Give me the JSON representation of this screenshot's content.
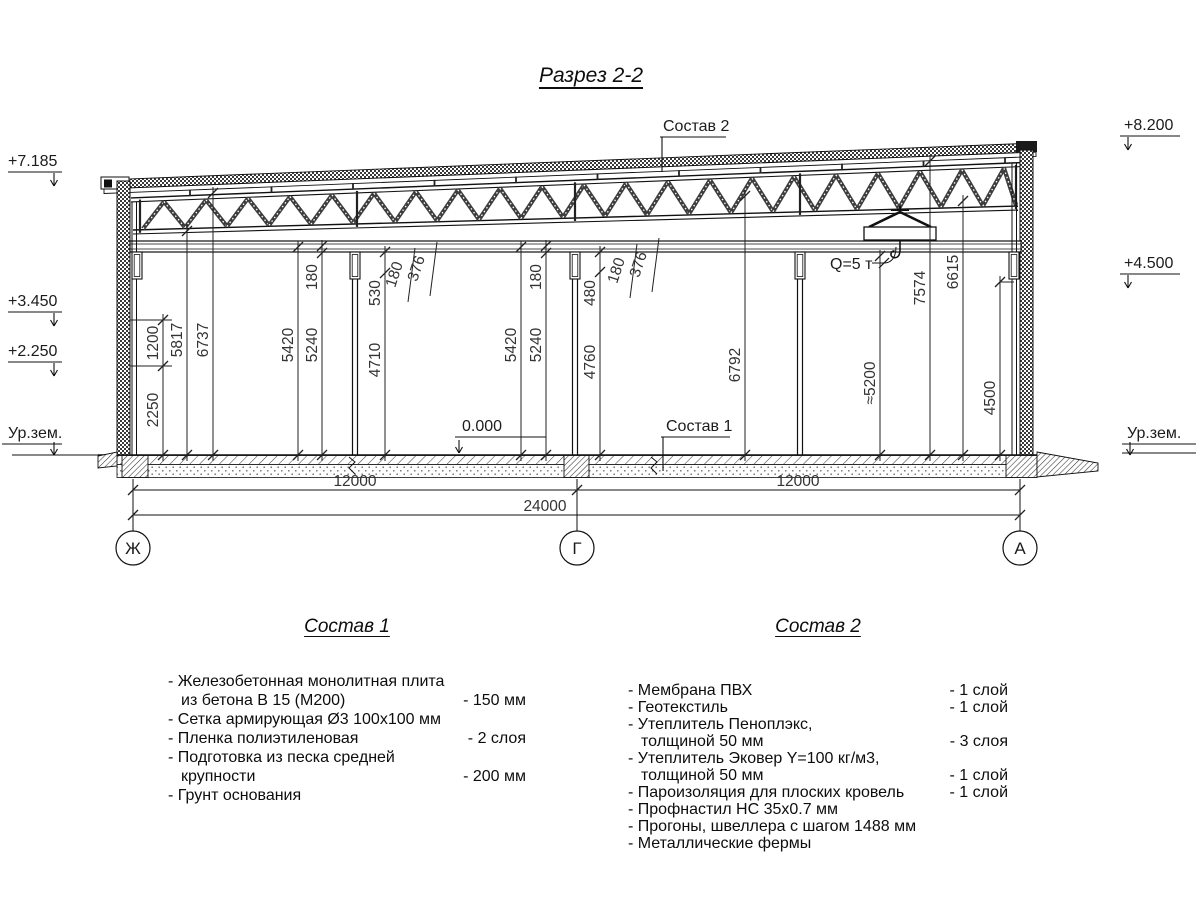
{
  "title": "Разрез 2-2",
  "labels": {
    "elev_left": [
      "+7.185",
      "+3.450",
      "+2.250"
    ],
    "elev_right": [
      "+8.200",
      "+4.500"
    ],
    "ground_left": "Ур.зем.",
    "ground_right": "Ур.зем.",
    "zero_level": "0.000",
    "crane_capacity": "Q=5 т",
    "callout_sostav1": "Состав 1",
    "callout_sostav2": "Состав 2"
  },
  "axes": [
    "Ж",
    "Г",
    "А"
  ],
  "dims": {
    "vertical": [
      "2250",
      "1200",
      "5817",
      "6737",
      "5420",
      "5240",
      "180",
      "530",
      "4710",
      "180",
      "376",
      "5420",
      "5240",
      "180",
      "480",
      "4760",
      "180",
      "376",
      "6792",
      "≈5200",
      "7574",
      "6615",
      "4500"
    ],
    "horizontal": [
      "12000",
      "12000",
      "24000"
    ]
  },
  "sostav1": {
    "title": "Состав 1",
    "items": [
      {
        "name": "- Железобетонная  монолитная плита\nиз бетона В 15 (М200)",
        "value": "- 150 мм"
      },
      {
        "name": "- Сетка армирующая Ø3 100х100 мм",
        "value": ""
      },
      {
        "name": "- Пленка полиэтиленовая",
        "value": "-  2 слоя"
      },
      {
        "name": "- Подготовка из песка средней\nкрупности",
        "value": "- 200 мм"
      },
      {
        "name": "- Грунт основания",
        "value": ""
      }
    ]
  },
  "sostav2": {
    "title": "Состав 2",
    "items": [
      {
        "name": "- Мембрана ПВХ",
        "value": "- 1 слой"
      },
      {
        "name": "- Геотекстиль",
        "value": "- 1 слой"
      },
      {
        "name": "- Утеплитель Пеноплэкс,\nтолщиной 50 мм",
        "value": "- 3 слоя"
      },
      {
        "name": "- Утеплитель Эковер Y=100 кг/м3,\nтолщиной 50 мм",
        "value": "- 1 слой"
      },
      {
        "name": "- Пароизоляция для плоских кровель",
        "value": "- 1 слой"
      },
      {
        "name": "- Профнастил НС 35х0.7 мм",
        "value": ""
      },
      {
        "name": "- Прогоны, швеллера с шагом 1488 мм",
        "value": ""
      },
      {
        "name": "- Металлические фермы",
        "value": ""
      }
    ]
  }
}
